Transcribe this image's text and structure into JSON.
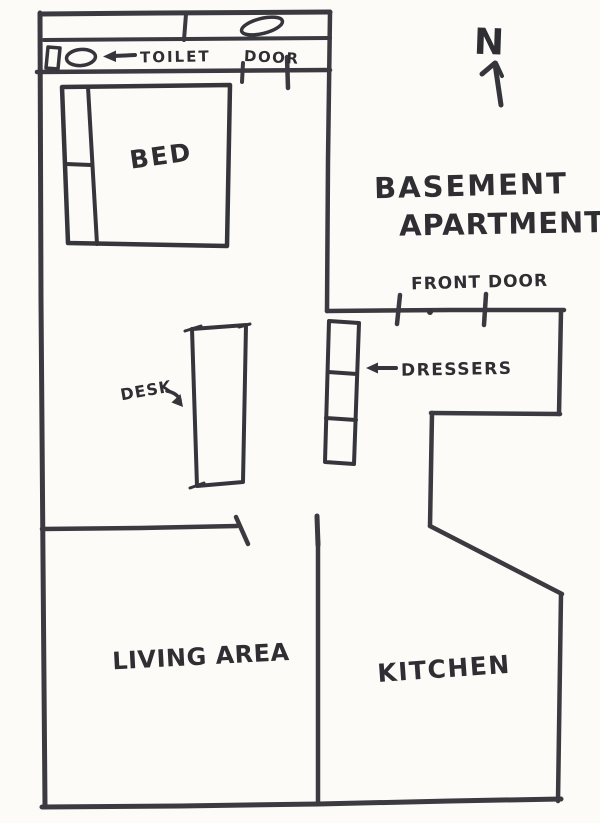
{
  "title": {
    "line1": "BASEMENT",
    "line2": "APARTMENT"
  },
  "compass": {
    "north_label": "N"
  },
  "rooms": {
    "bed": "BED",
    "living_area": "LIVING AREA",
    "kitchen": "KITCHEN"
  },
  "labels": {
    "toilet": "TOILET",
    "door": "DOOR",
    "front_door": "FRONT DOOR",
    "dressers": "DRESSERS",
    "desk": "DESK"
  },
  "colors": {
    "ink": "#3a3a40",
    "text_ink": "#2e2e33",
    "paper": "#fcfbf8"
  }
}
